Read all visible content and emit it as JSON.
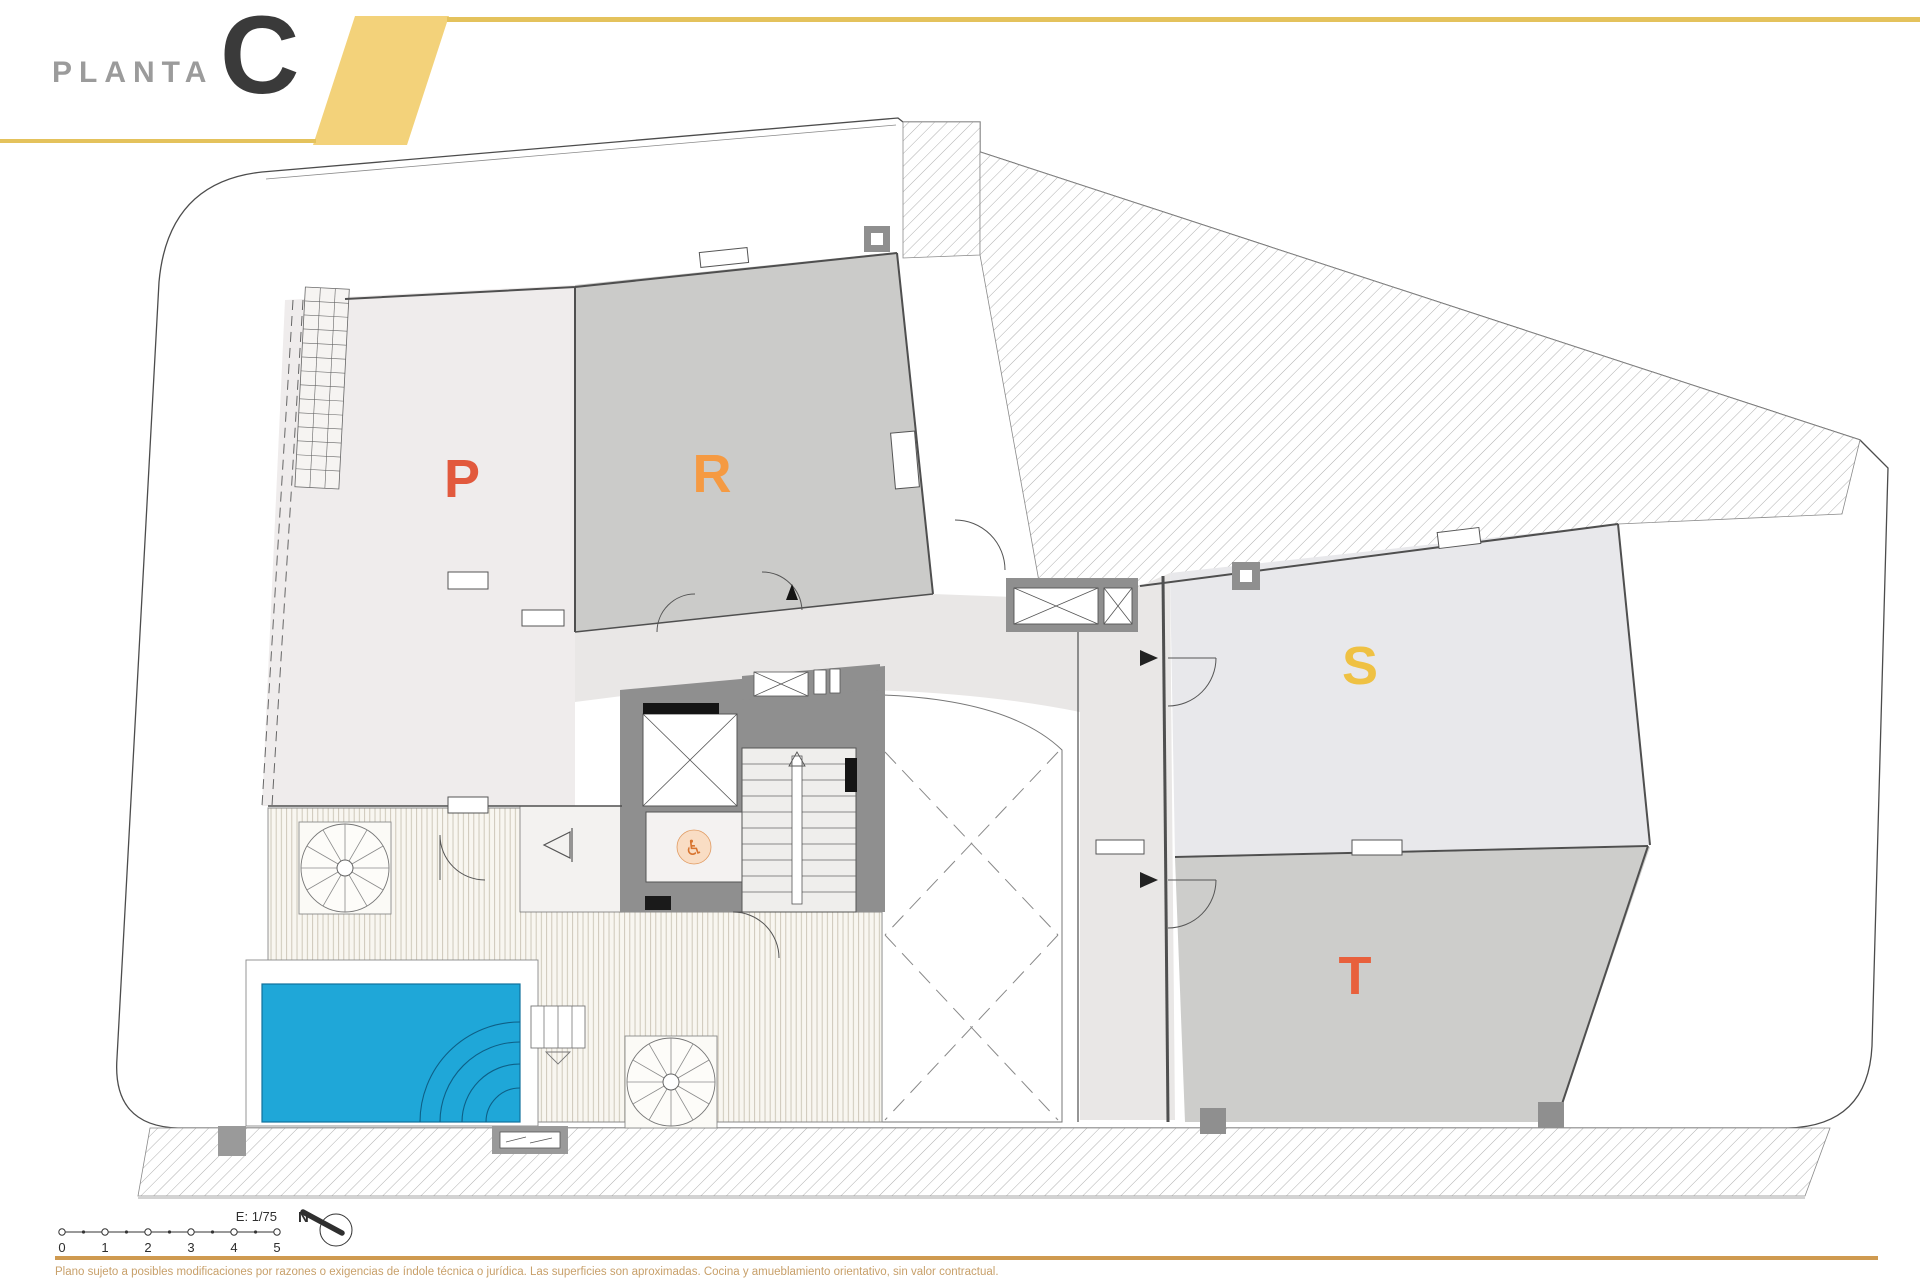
{
  "header": {
    "title": "PLANTA",
    "plan_letter": "C"
  },
  "units": [
    {
      "id": "P",
      "label": "P",
      "color": "#e2593d"
    },
    {
      "id": "R",
      "label": "R",
      "color": "#f59a42"
    },
    {
      "id": "S",
      "label": "S",
      "color": "#efc143"
    },
    {
      "id": "T",
      "label": "T",
      "color": "#e8603c"
    }
  ],
  "plan_features": {
    "pool": "swimming-pool",
    "pool_color": "#1fa7d8",
    "deck": "wood-decking",
    "elevator_icon": "♿",
    "spiral_stairs_count": 2,
    "wall_color": "#8f8f8f"
  },
  "scalebar": {
    "scale_label": "E: 1/75",
    "north_label": "N",
    "ticks": [
      "0",
      "1",
      "2",
      "3",
      "4",
      "5"
    ]
  },
  "footer": {
    "disclaimer": "Plano sujeto a posibles modificaciones por razones o exigencias de índole técnica o jurídica. Las superficies son aproximadas. Cocina y amueblamiento orientativo, sin valor contractual."
  },
  "colors": {
    "accent_yellow": "#e4c25c",
    "parallelogram_fill": "#f3d27a",
    "title_gray": "#9b9b9b",
    "letter_dark": "#3a3a3a",
    "footer_rule": "#cf9a50",
    "footer_text": "#c8a06a"
  }
}
